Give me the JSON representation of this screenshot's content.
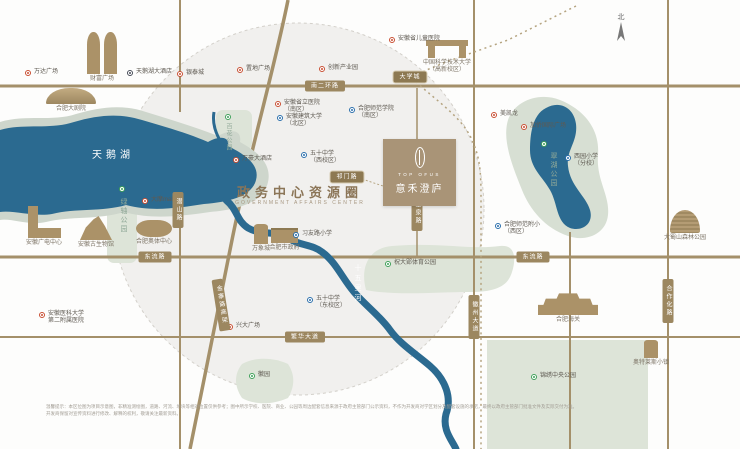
{
  "circle": {
    "title": "政务中心资源圈",
    "subtitle": "GOVERNMENT AFFAIRS CENTER"
  },
  "project": {
    "name_en": "TOP OFUS",
    "name_zh": "意禾澄庐"
  },
  "compass_label": "北",
  "colors": {
    "water": "#2b6a90",
    "shore": "#ced6cc",
    "park": "#dde4d8",
    "road": "#a4906a",
    "badge_bg": "#9c8760",
    "circle_fill": "#f1f0ee",
    "logo_bg": "#a99477",
    "marker_red": "#c94f33",
    "marker_blue": "#2a6fac",
    "marker_dark": "#474c58",
    "marker_green": "#3fa05a",
    "title_brown": "#8b7557"
  },
  "pois": [
    {
      "id": "wanda-plaza",
      "type": "red",
      "x": 28,
      "y": 73,
      "lines": [
        "万达广场"
      ]
    },
    {
      "id": "swan-lake-hotel",
      "type": "dark",
      "x": 130,
      "y": 73,
      "lines": [
        "天鹅湖大酒店"
      ]
    },
    {
      "id": "yintai-city",
      "type": "red",
      "x": 180,
      "y": 74,
      "lines": [
        "银泰城"
      ]
    },
    {
      "id": "zhidi-plaza",
      "type": "red",
      "x": 240,
      "y": 70,
      "lines": [
        "置地广场"
      ]
    },
    {
      "id": "innovation-industry-park",
      "type": "red",
      "x": 322,
      "y": 69,
      "lines": [
        "创新产业园"
      ]
    },
    {
      "id": "children-hospital",
      "type": "red",
      "x": 392,
      "y": 40,
      "lines": [
        "安徽省儿童医院"
      ]
    },
    {
      "id": "provincial-hospital-south",
      "type": "red",
      "x": 278,
      "y": 104,
      "lines": [
        "安徽省立医院",
        "（南区）"
      ]
    },
    {
      "id": "anhui-jianzhu-univ",
      "type": "blue",
      "x": 280,
      "y": 118,
      "lines": [
        "安徽建筑大学",
        "（北区）"
      ]
    },
    {
      "id": "hefei-normal-college",
      "type": "blue",
      "x": 352,
      "y": 110,
      "lines": [
        "合肥师范学院",
        "（南区）"
      ]
    },
    {
      "id": "macalline",
      "type": "red",
      "x": 494,
      "y": 115,
      "lines": [
        "美凯龙"
      ]
    },
    {
      "id": "jiaqiao-intl-plaza",
      "type": "red",
      "x": 524,
      "y": 127,
      "lines": [
        "加侨国际广场"
      ]
    },
    {
      "id": "xiyuan-primary",
      "type": "blue",
      "x": 568,
      "y": 158,
      "lines": [
        "西园小学",
        "（分校）"
      ]
    },
    {
      "id": "shifan-primary",
      "type": "blue",
      "x": 498,
      "y": 226,
      "lines": [
        "合肥师范附小",
        "（西区）"
      ]
    },
    {
      "id": "marriott-hotel",
      "type": "red",
      "x": 236,
      "y": 160,
      "lines": [
        "万豪大酒店"
      ]
    },
    {
      "id": "damo-mall",
      "type": "red",
      "x": 145,
      "y": 201,
      "lines": [
        "大摩mall"
      ]
    },
    {
      "id": "no50-middle-west",
      "type": "blue",
      "x": 304,
      "y": 155,
      "lines": [
        "五十中学",
        "（西校区）"
      ]
    },
    {
      "id": "xiyoulu-primary",
      "type": "blue",
      "x": 296,
      "y": 235,
      "lines": [
        "习友路小学"
      ]
    },
    {
      "id": "no50-middle-east",
      "type": "blue",
      "x": 310,
      "y": 300,
      "lines": [
        "五十中学",
        "（东校区）"
      ]
    },
    {
      "id": "xingda-plaza",
      "type": "red",
      "x": 230,
      "y": 327,
      "lines": [
        "兴大广场"
      ]
    },
    {
      "id": "anyi-second-hospital",
      "type": "red",
      "x": 42,
      "y": 315,
      "lines": [
        "安徽医科大学",
        "第二附属医院"
      ]
    },
    {
      "id": "huiyuan-park",
      "type": "green",
      "x": 252,
      "y": 376,
      "lines": [
        "徽园"
      ]
    },
    {
      "id": "zhudaying-sports-park",
      "type": "green",
      "x": 388,
      "y": 264,
      "lines": [
        "祝大郢体育公园"
      ]
    },
    {
      "id": "jinxiu-central-park",
      "type": "green",
      "x": 534,
      "y": 377,
      "lines": [
        "锦绣中央公园"
      ]
    },
    {
      "id": "luzhou-axis-tree",
      "type": "green",
      "x": 122,
      "y": 189,
      "lines": []
    },
    {
      "id": "right-park-tree",
      "type": "green",
      "x": 544,
      "y": 144,
      "lines": []
    },
    {
      "id": "small-park-tree",
      "type": "green",
      "x": 228,
      "y": 117,
      "lines": []
    },
    {
      "id": "swan-lake-name",
      "type": "text-white",
      "x": 92,
      "y": 146,
      "lines": [
        "天鹅湖"
      ],
      "size": 10,
      "ls": 4
    },
    {
      "id": "shiwuli-river-name",
      "type": "vtext-white",
      "x": 352,
      "y": 264,
      "lines": [
        "十五里河"
      ],
      "size": 7,
      "ls": 3
    },
    {
      "id": "right-park-name",
      "type": "vtext-green",
      "x": 548,
      "y": 152,
      "lines": [
        "翠湖公园"
      ],
      "size": 7,
      "ls": 2
    },
    {
      "id": "luzhou-axis-name",
      "type": "vtext-green",
      "x": 118,
      "y": 198,
      "lines": [
        "绿轴公园"
      ],
      "size": 7,
      "ls": 2
    },
    {
      "id": "small-park-name",
      "type": "vtext-green",
      "x": 224,
      "y": 123,
      "lines": [
        "百花公园"
      ],
      "size": 6,
      "ls": 1
    }
  ],
  "road_badges": [
    {
      "id": "south-2nd-ring-badge",
      "x": 325,
      "y": 86,
      "text": "南二环路",
      "vertical": false
    },
    {
      "id": "dongliu-road-west-badge",
      "x": 155,
      "y": 257,
      "text": "东流路",
      "vertical": false
    },
    {
      "id": "dongliu-road-east-badge",
      "x": 533,
      "y": 257,
      "text": "东流路",
      "vertical": false
    },
    {
      "id": "fanhua-avenue-badge",
      "x": 305,
      "y": 337,
      "text": "繁华大道",
      "vertical": false
    },
    {
      "id": "qianshan-road-badge",
      "x": 178,
      "y": 210,
      "text": "潜山路",
      "vertical": true
    },
    {
      "id": "shengquan-road-badge",
      "x": 417,
      "y": 213,
      "text": "圣泉路",
      "vertical": true
    },
    {
      "id": "huizhou-avenue-badge",
      "x": 474,
      "y": 317,
      "text": "徽州大道",
      "vertical": true
    },
    {
      "id": "hezuohua-road-badge",
      "x": 668,
      "y": 301,
      "text": "合作化路",
      "vertical": true
    },
    {
      "id": "jinzhai-road-badge",
      "x": 221,
      "y": 305,
      "text": "金寨路高架",
      "vertical": true,
      "rot": -9
    },
    {
      "id": "daxuecheng-station-badge",
      "x": 410,
      "y": 77,
      "text": "大学城",
      "vertical": false,
      "station": true
    },
    {
      "id": "qimenlu-station-badge",
      "x": 347,
      "y": 177,
      "text": "祁门路",
      "vertical": false,
      "station": true
    }
  ],
  "buildings": [
    {
      "id": "caifu-plaza",
      "shape": "twin",
      "x": 86,
      "y": 32,
      "w": 32,
      "h": 42,
      "label": [
        "财富广场"
      ]
    },
    {
      "id": "grand-theater",
      "shape": "shell",
      "x": 46,
      "y": 88,
      "w": 50,
      "h": 16,
      "label": [
        "合肥大剧院"
      ]
    },
    {
      "id": "ahtv-center",
      "shape": "lshape",
      "x": 26,
      "y": 206,
      "w": 36,
      "h": 32,
      "label": [
        "安徽广电中心"
      ]
    },
    {
      "id": "paleontology-museum",
      "shape": "mound",
      "x": 80,
      "y": 216,
      "w": 32,
      "h": 24,
      "label": [
        "安徽古生物馆"
      ]
    },
    {
      "id": "olympic-sports-center",
      "shape": "stadium",
      "x": 136,
      "y": 220,
      "w": 36,
      "h": 17,
      "label": [
        "合肥奥体中心"
      ]
    },
    {
      "id": "mixc-mall",
      "shape": "tower",
      "x": 254,
      "y": 224,
      "w": 14,
      "h": 20,
      "label": [
        "万象城"
      ]
    },
    {
      "id": "city-government",
      "shape": "wide",
      "x": 271,
      "y": 228,
      "w": 27,
      "h": 15,
      "label": [
        "合肥市政府"
      ]
    },
    {
      "id": "ustc-gaoxin",
      "shape": "gate",
      "x": 426,
      "y": 40,
      "w": 42,
      "h": 18,
      "label": [
        "中国科学技术大学",
        "（高新校区）"
      ]
    },
    {
      "id": "hefei-customs",
      "shape": "palace",
      "x": 538,
      "y": 291,
      "w": 60,
      "h": 24,
      "label": [
        "合肥海关"
      ]
    },
    {
      "id": "dashu-mountain",
      "shape": "dome",
      "x": 670,
      "y": 210,
      "w": 30,
      "h": 23,
      "label": [
        "大蜀山森林公园"
      ]
    },
    {
      "id": "outlets-town",
      "shape": "tower",
      "x": 644,
      "y": 340,
      "w": 14,
      "h": 18,
      "label": [
        "奥特莱斯小镇"
      ]
    }
  ],
  "disclaimer": {
    "line1": "温馨提示：本区位图为项目示意图，非精准测绘图，道路、河流、地块等相对位置仅供参考；图中所示学校、医院、商业、公园等周边配套信息来源于政府主管部门公示资料，不作为开发商对学区划分及配套设施的承诺，最终以政府主管部门批准文件及实际交付为准。",
    "line2": "开发商保留对宣传资料进行修改、解释的权利，敬请关注最新资料。"
  }
}
